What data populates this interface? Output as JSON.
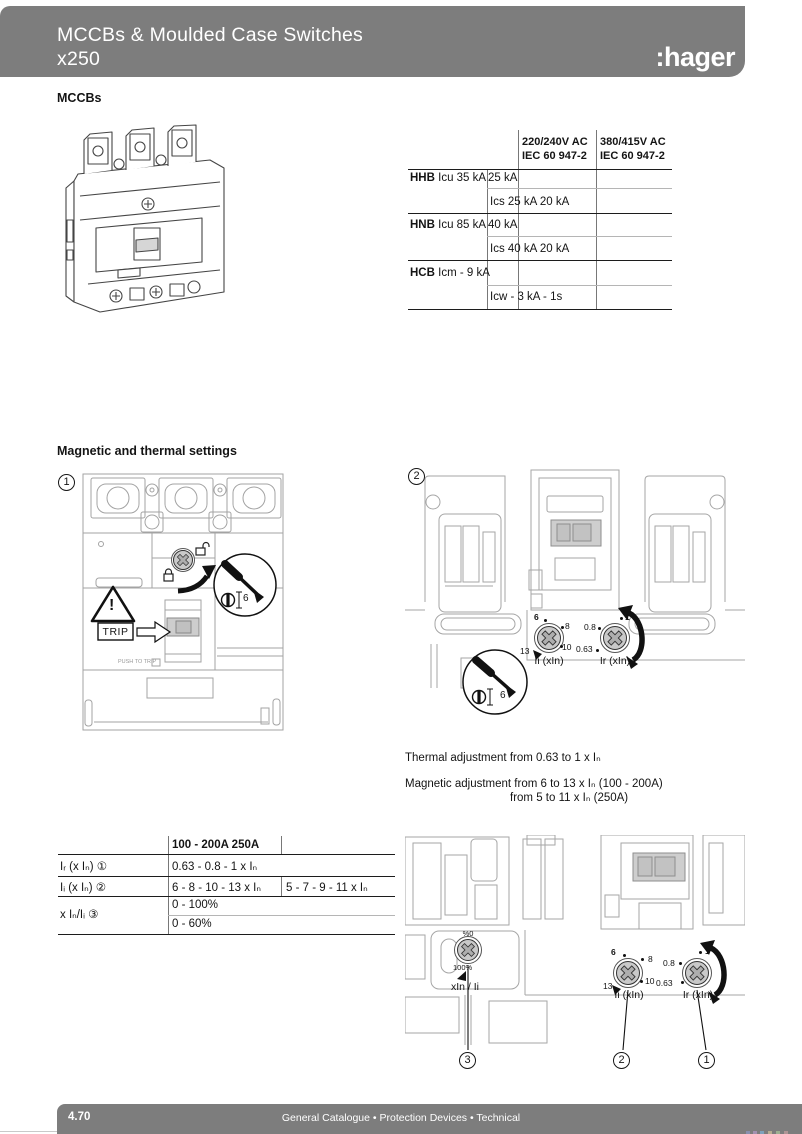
{
  "header": {
    "title_line1": "MCCBs & Moulded Case Switches",
    "title_line2": "x250",
    "logo": ":hager"
  },
  "labels": {
    "mccbs": "MCCBs",
    "settings": "Magnetic and thermal settings"
  },
  "ratings_table": {
    "col1": {
      "line1": "220/240V AC",
      "line2": "IEC 60 947-2"
    },
    "col2": {
      "line1": "380/415V AC",
      "line2": "IEC 60 947-2"
    },
    "rows": [
      {
        "code": "HHB",
        "label": "Icu 35 kA",
        "value": "25 kA"
      },
      {
        "code": "",
        "label": "",
        "value": "Ics 25 kA 20 kA"
      },
      {
        "code": "HNB",
        "label": "Icu 85 kA",
        "value": "40 kA"
      },
      {
        "code": "",
        "label": "",
        "value": "Ics 40 kA 20 kA"
      },
      {
        "code": "HCB",
        "label": "Icm - 9 kA",
        "value": ""
      },
      {
        "code": "",
        "label": "",
        "value": "Icw - 3 kA - 1s"
      }
    ]
  },
  "diagram1": {
    "number": "1",
    "trip": "TRIP",
    "push_to_trip": "PUSH TO TRIP",
    "warning": "!",
    "driver_size": "6"
  },
  "diagram2": {
    "number": "2",
    "driver_size": "6",
    "dial_ii": {
      "t1": "6",
      "t2": "8",
      "t3": "10",
      "t4": "13",
      "label": "Ii (xIn)"
    },
    "dial_ir": {
      "t1": "1",
      "t2": "0.8",
      "t3": "0.63",
      "label": "Ir (xIn)"
    }
  },
  "adjustment": {
    "line1": "Thermal adjustment from 0.63 to 1 x Iₙ",
    "line2": "Magnetic adjustment from 6 to 13 x Iₙ (100 - 200A)",
    "line3": "from 5 to 11 x Iₙ (250A)"
  },
  "settings_table": {
    "header": "100 - 200A 250A",
    "rows": [
      {
        "label": "Iᵣ (x Iₙ) ①",
        "v1": "0.63 - 0.8 - 1 x Iₙ",
        "v2": ""
      },
      {
        "label": "Iᵢ (x Iₙ) ②",
        "v1": "6 - 8 - 10 - 13 x Iₙ",
        "v2": "5 - 7 - 9 - 11 x Iₙ"
      },
      {
        "label": "x Iₙ/Iᵢ ③",
        "v1": "0 - 100%",
        "v2": "0 - 60%"
      }
    ]
  },
  "diagram3": {
    "dial_pct": {
      "top": "%0",
      "bottom": "100%",
      "label": "xIn / Ii"
    },
    "dial_ii": {
      "t1": "6",
      "t2": "8",
      "t3": "10",
      "t4": "13",
      "label": "Ii (xIn)"
    },
    "dial_ir": {
      "t1": "1",
      "t2": "0.8",
      "t3": "0.63",
      "label": "Ir (xIn)"
    },
    "callout3": "3",
    "callout2": "2",
    "callout1": "1"
  },
  "footer": {
    "page": "4.70",
    "text": "General Catalogue • Protection Devices • Technical"
  },
  "colors": {
    "bar_gray": "#7d7d7d",
    "knob_gray": "#c9c9c9"
  }
}
